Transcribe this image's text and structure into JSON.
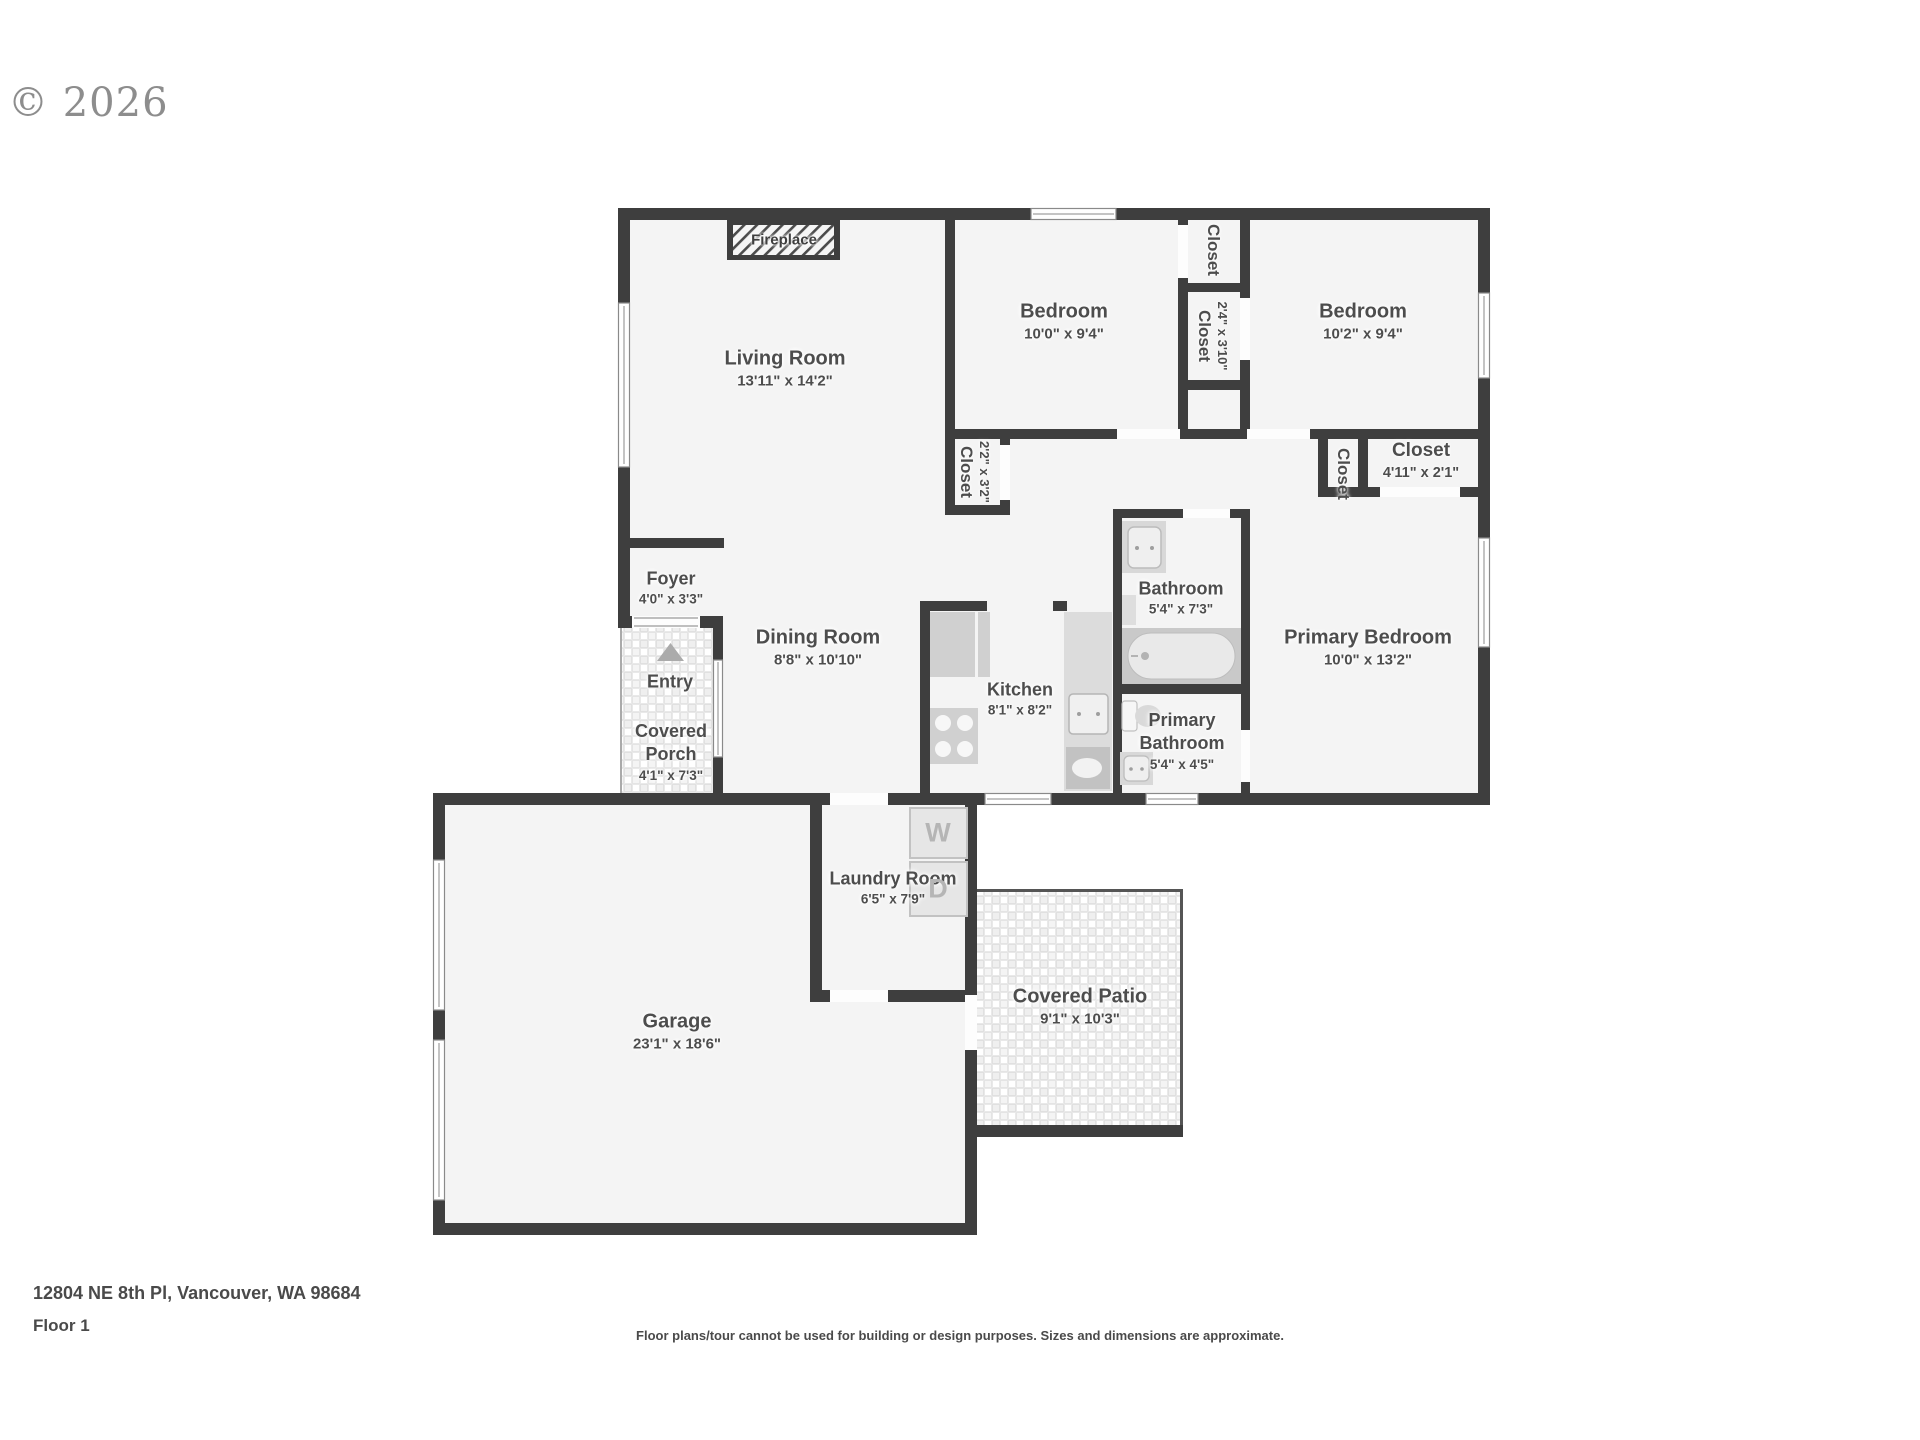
{
  "watermark": "© 2026",
  "fireplace_label": "Fireplace",
  "rooms": [
    {
      "id": "living-room",
      "name": "Living Room",
      "dims": "13'11\" x 14'2\""
    },
    {
      "id": "bedroom-1",
      "name": "Bedroom",
      "dims": "10'0\" x 9'4\""
    },
    {
      "id": "bedroom-2",
      "name": "Bedroom",
      "dims": "10'2\" x 9'4\""
    },
    {
      "id": "dining-room",
      "name": "Dining Room",
      "dims": "8'8\" x 10'10\""
    },
    {
      "id": "kitchen",
      "name": "Kitchen",
      "dims": "8'1\" x 8'2\""
    },
    {
      "id": "bathroom",
      "name": "Bathroom",
      "dims": "5'4\" x 7'3\""
    },
    {
      "id": "primary-bathroom",
      "name": "Primary Bathroom",
      "dims": "5'4\" x 4'5\""
    },
    {
      "id": "primary-bedroom",
      "name": "Primary Bedroom",
      "dims": "10'0\" x 13'2\""
    },
    {
      "id": "foyer",
      "name": "Foyer",
      "dims": "4'0\" x 3'3\""
    },
    {
      "id": "entry",
      "name": "Entry",
      "dims": ""
    },
    {
      "id": "covered-porch",
      "name": "Covered Porch",
      "dims": "4'1\" x 7'3\""
    },
    {
      "id": "laundry-room",
      "name": "Laundry Room",
      "dims": "6'5\" x 7'9\""
    },
    {
      "id": "garage",
      "name": "Garage",
      "dims": "23'1\" x 18'6\""
    },
    {
      "id": "covered-patio",
      "name": "Covered Patio",
      "dims": "9'1\" x 10'3\""
    }
  ],
  "closets": [
    {
      "name": "Closet",
      "dims": ""
    },
    {
      "name": "Closet",
      "dims": "2'4\" x 3'10\""
    },
    {
      "name": "Closet",
      "dims": "2'2\" x 3'2\""
    },
    {
      "name": "Closet",
      "dims": ""
    },
    {
      "name": "Closet",
      "dims": "4'11\" x 2'1\""
    }
  ],
  "laundry_appliances": {
    "washer": "W",
    "dryer": "D"
  },
  "footer": {
    "address": "12804 NE 8th Pl, Vancouver, WA 98684",
    "floor": "Floor 1",
    "disclaimer": "Floor plans/tour cannot be used for building or design purposes. Sizes and dimensions are approximate."
  }
}
